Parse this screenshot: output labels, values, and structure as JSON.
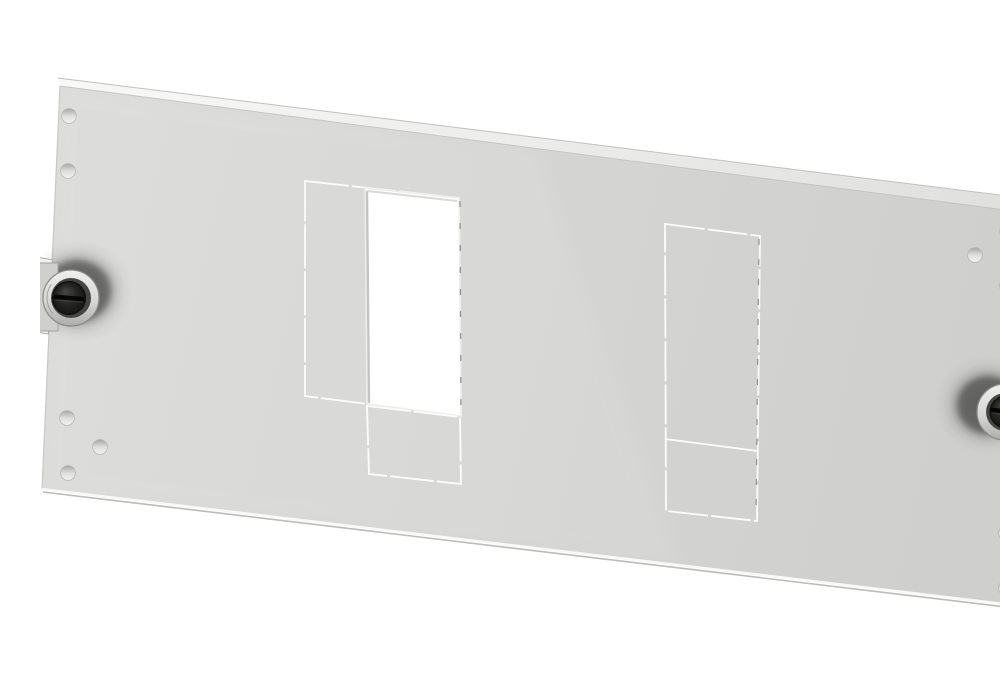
{
  "scene": {
    "description": "Light grey sheet-metal front panel photographed at a slight perspective angle on a white background. The panel has a bright folded top edge, a darker folded right edge, two rectangular knockout outlines scored into the face (the upper part of the left one is punched open), rows of small round mounting holes near the left and right edges, and two black slotted quarter-turn locks mounted on the left and right sides.",
    "background": "#ffffff",
    "width": 1000,
    "height": 666
  },
  "palette": {
    "face_left": "#dbdbd9",
    "face_right": "#cfcfcd",
    "top_face_left": "#f8f8f6",
    "top_face_right": "#dfdfdd",
    "flange_top": "#c9c9c7",
    "flange_bottom": "#a9a9a7",
    "flange_dark": "#3c3c3a",
    "edge_outline": "#c0c0be",
    "edge_crease": "#c3c3c1",
    "edge_left": "#c8c8c6",
    "bottom_highlight": "#f8f8f6",
    "bottom_shadow": "#a5a5a3",
    "right_crease": "#b4b4b2",
    "score_line": "#fcfcfa",
    "score_dark": "#8e8e8c",
    "aperture_fill": "#ffffff",
    "aperture_edge": "#ededeb",
    "aperture_inner_left": "#c4c4c2",
    "aperture_inner_top": "#d9d9d7",
    "hole_rim_dark": "#a6a6a4",
    "hole_fill": "#dededc",
    "hole_rim_light": "#f4f4f2",
    "hole_stroke": "#b2b2b0",
    "ring_light": "#efefed",
    "ring_mid": "#d7d7d5",
    "ring_dark": "#adadab",
    "ring_stroke": "#8a8a88",
    "recess": "#454543",
    "knob_light": "#484846",
    "knob_mid": "#232321",
    "knob_dark": "#111111",
    "knob_stroke": "#0a0a08",
    "slot": "#060604",
    "slot_glint": "#4a4a48",
    "shadow": "#2b2b29",
    "plate": "#cfcfcd",
    "plate_stroke": "#a0a09e",
    "tab": "#f1f1ef",
    "sheen": "#ffffff"
  },
  "panel": {
    "face": [
      [
        20,
        70
      ],
      [
        988,
        197
      ],
      [
        991,
        591
      ],
      [
        2,
        473
      ]
    ],
    "top_face": [
      [
        18,
        62
      ],
      [
        992,
        183
      ],
      [
        988,
        197
      ],
      [
        20,
        70
      ]
    ],
    "right_flange": [
      [
        988,
        197
      ],
      [
        992,
        183
      ],
      [
        999,
        226
      ],
      [
        1000,
        590
      ],
      [
        991,
        591
      ]
    ],
    "flange_dark_edges": [
      [
        996,
        203,
        999,
        280
      ],
      [
        997,
        440,
        1000,
        500
      ],
      [
        998,
        556,
        1000,
        590
      ]
    ],
    "edges": {
      "top_outer": [
        [
          18,
          62
        ],
        [
          992,
          183
        ]
      ],
      "top_crease": [
        [
          20,
          70
        ],
        [
          988,
          197
        ]
      ],
      "left": [
        [
          20,
          70
        ],
        [
          2,
          473
        ]
      ],
      "bottom_highlight": [
        [
          2,
          473
        ],
        [
          991,
          591
        ]
      ],
      "bottom_shadow": [
        [
          3,
          476
        ],
        [
          991,
          594
        ]
      ],
      "right_crease": [
        [
          988,
          197
        ],
        [
          991,
          591
        ]
      ]
    },
    "sheen": [
      [
        20,
        70
      ],
      [
        495,
        132
      ],
      [
        640,
        551
      ],
      [
        2,
        473
      ]
    ]
  },
  "cutouts": {
    "left_outline": [
      [
        265,
        165
      ],
      [
        419,
        182
      ],
      [
        421,
        400
      ],
      [
        265,
        380
      ]
    ],
    "left_aperture": [
      [
        325,
        172
      ],
      [
        419,
        182
      ],
      [
        421,
        400
      ],
      [
        327,
        388
      ]
    ],
    "left_aperture_inner_left": [
      [
        327,
        175
      ],
      [
        329,
        387
      ]
    ],
    "left_aperture_inner_top": [
      [
        327,
        175
      ],
      [
        417,
        185
      ]
    ],
    "left_aperture_dark_edge": [
      [
        420,
        185
      ],
      [
        421,
        398
      ]
    ],
    "left_lower": [
      [
        327,
        390
      ],
      [
        420,
        401
      ],
      [
        421,
        468
      ],
      [
        329,
        458
      ]
    ],
    "right_outline": [
      [
        625,
        208
      ],
      [
        720,
        220
      ],
      [
        717,
        505
      ],
      [
        626,
        495
      ]
    ],
    "right_divider": [
      [
        625,
        423
      ],
      [
        718,
        435
      ]
    ],
    "right_dark_edge": [
      [
        719,
        223
      ],
      [
        716,
        503
      ]
    ]
  },
  "holes": {
    "radius": 7.4,
    "centers": [
      [
        29,
        100
      ],
      [
        28,
        155
      ],
      [
        27,
        402
      ],
      [
        60,
        431
      ],
      [
        28,
        457
      ],
      [
        967,
        215
      ],
      [
        935,
        239
      ],
      [
        967,
        270
      ],
      [
        966,
        517
      ],
      [
        966,
        572
      ]
    ]
  },
  "locks": {
    "left": {
      "shadow": {
        "cx": 37,
        "cy": 275,
        "rx": 34,
        "ry": 31
      },
      "plate": {
        "x": -8,
        "y": 247,
        "w": 26,
        "h": 68
      },
      "tabs": [
        [
          [
            -4,
            241
          ],
          [
            13,
            244
          ],
          [
            9,
            257
          ],
          [
            -4,
            255
          ]
        ],
        [
          [
            -4,
            302
          ],
          [
            12,
            305
          ],
          [
            8,
            318
          ],
          [
            -4,
            316
          ]
        ]
      ],
      "ring": {
        "cx": 31,
        "cy": 282,
        "r": 28
      },
      "recess_r": 20,
      "knob": {
        "cx": 29,
        "cy": 282,
        "r": 16.5
      },
      "slot": [
        [
          16,
          281
        ],
        [
          42,
          283
        ]
      ],
      "marking": {
        "cx": 31,
        "cy": 282,
        "r": 24,
        "a1": 140,
        "a2": 215
      }
    },
    "right": {
      "shadow": {
        "cx": 948,
        "cy": 389,
        "rx": 31,
        "ry": 29
      },
      "plate": {
        "x": 978,
        "y": 352,
        "w": 26,
        "h": 90
      },
      "tabs": [
        [
          [
            984,
            372
          ],
          [
            992,
            352
          ],
          [
            1000,
            356
          ],
          [
            992,
            374
          ]
        ],
        [
          [
            984,
            420
          ],
          [
            998,
            430
          ],
          [
            993,
            443
          ],
          [
            982,
            432
          ]
        ]
      ],
      "ring": {
        "cx": 965,
        "cy": 396,
        "r": 28
      },
      "recess_r": 19,
      "knob": {
        "cx": 966,
        "cy": 396,
        "r": 16
      },
      "slot": [
        [
          952,
          394
        ],
        [
          980,
          397
        ]
      ],
      "marking": {
        "cx": 965,
        "cy": 396,
        "r": 23,
        "a1": -45,
        "a2": 45
      }
    }
  }
}
